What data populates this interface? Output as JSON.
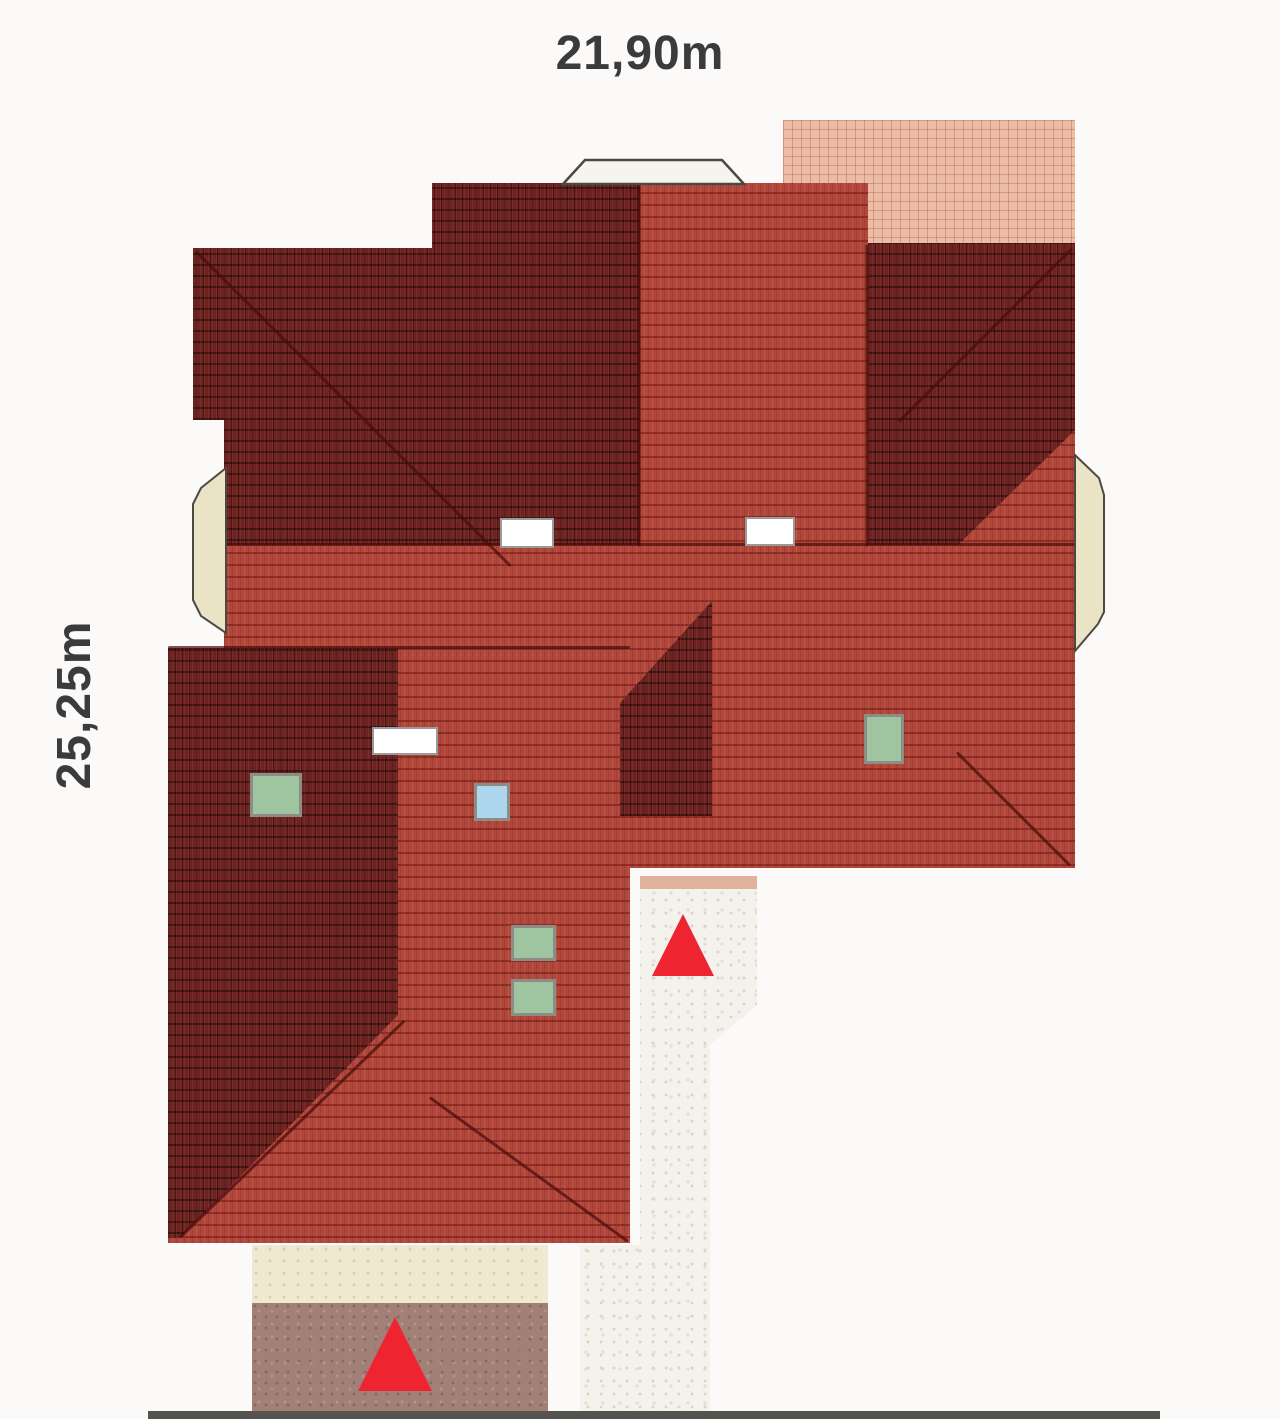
{
  "plan": {
    "width_label": "21,90m",
    "height_label": "25,25m"
  },
  "legend": {
    "roof_tile_bright": "#b2463a",
    "roof_tile_dark": "#6f2321",
    "upper_terrace_pink": "#ecbca6",
    "lower_terrace_brown": "#a28077",
    "paving_cream": "#efe9d2",
    "gravel_path": "#f4f2ec",
    "bay_window_fill": "#eae3c5",
    "chimney_fill": "#ffffff",
    "skylight_green": "#9fc4a0",
    "skylight_blue": "#aed6ee",
    "entrance_marker_red": "#ee2430",
    "dimension_text": "#3b3b3b"
  },
  "features": {
    "chimneys": 3,
    "skylights_green": 4,
    "skylights_blue": 1,
    "bay_windows": 3,
    "entrance_markers": 2
  }
}
